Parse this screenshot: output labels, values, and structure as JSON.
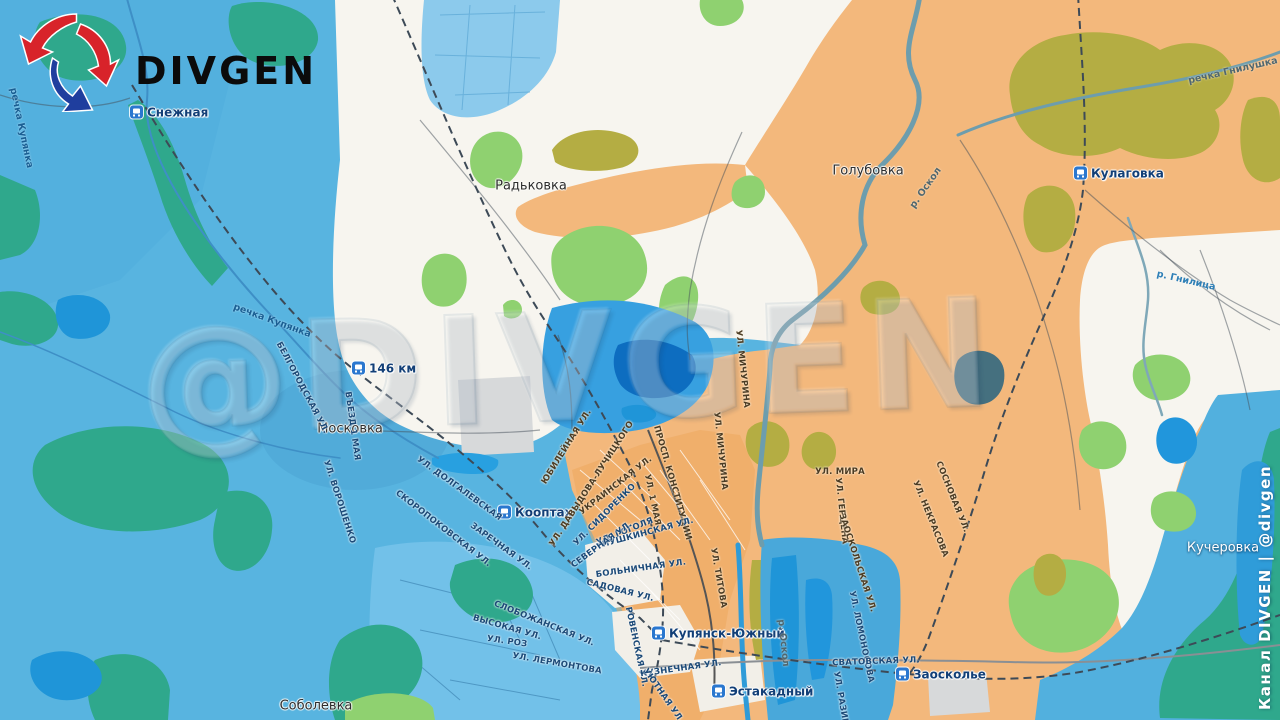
{
  "brand": {
    "logo_text": "DIVGEN"
  },
  "watermark": {
    "text": "@DIVGEN"
  },
  "credit": {
    "text": "Канал DIVGEN | @divgen"
  },
  "palette": {
    "ukraine_zone": "#58b4e0",
    "russia_zone": "#f3b87c",
    "contested_zone": "#f7f5ef",
    "forest_teal": "#2fa88c",
    "forest_light_green": "#8fd170",
    "forest_olive": "#b4ad43",
    "water_bright": "#1f95d8",
    "river_steel": "#6d9dad",
    "station_icon_blue": "#2a77cf",
    "logo_red": "#d8232a",
    "logo_blue": "#1f3e9e"
  },
  "map": {
    "labels": [
      {
        "type": "station",
        "text": "Снежная",
        "x": 130,
        "y": 112,
        "rot": 0,
        "anchor": "left"
      },
      {
        "type": "station",
        "text": "146 км",
        "x": 352,
        "y": 368,
        "rot": 0,
        "anchor": "left"
      },
      {
        "type": "station",
        "text": "Кооптах",
        "x": 498,
        "y": 512,
        "rot": 0,
        "anchor": "left"
      },
      {
        "type": "station",
        "text": "Купянск-Южный",
        "x": 652,
        "y": 633,
        "rot": 0,
        "anchor": "left"
      },
      {
        "type": "station",
        "text": "Эстакадный",
        "x": 712,
        "y": 691,
        "rot": 0,
        "anchor": "left"
      },
      {
        "type": "station",
        "text": "Заосколье",
        "x": 896,
        "y": 674,
        "rot": 0,
        "anchor": "left"
      },
      {
        "type": "station",
        "text": "Кулаговка",
        "x": 1074,
        "y": 173,
        "rot": 0,
        "anchor": "left"
      },
      {
        "type": "settlement",
        "text": "Радьковка",
        "x": 531,
        "y": 186,
        "rot": 0
      },
      {
        "type": "settlement",
        "text": "Голубовка",
        "x": 868,
        "y": 171,
        "rot": 0
      },
      {
        "type": "settlement",
        "text": "Московка",
        "x": 350,
        "y": 429,
        "rot": 0
      },
      {
        "type": "settlement",
        "text": "Соболевка",
        "x": 316,
        "y": 706,
        "rot": 0
      },
      {
        "type": "settlement-light",
        "text": "Кучеровка",
        "x": 1223,
        "y": 548,
        "rot": 0
      },
      {
        "type": "river-blue",
        "text": "речка Купянка",
        "x": 21,
        "y": 128,
        "rot": 78
      },
      {
        "type": "river-blue",
        "text": "речка Купянка",
        "x": 272,
        "y": 321,
        "rot": 20
      },
      {
        "type": "river-steel",
        "text": "р. Оскол",
        "x": 926,
        "y": 188,
        "rot": -55
      },
      {
        "type": "river-steel",
        "text": "р. Оскол",
        "x": 783,
        "y": 643,
        "rot": 84
      },
      {
        "type": "river-steel",
        "text": "речка Гнилушка",
        "x": 1233,
        "y": 71,
        "rot": -13
      },
      {
        "type": "river-bright",
        "text": "р. Гнилица",
        "x": 1186,
        "y": 281,
        "rot": 13
      },
      {
        "type": "street-blue",
        "text": "Белгородская ул.",
        "x": 302,
        "y": 388,
        "rot": 62
      },
      {
        "type": "street-blue",
        "text": "въезд 1 Мая",
        "x": 352,
        "y": 426,
        "rot": 82
      },
      {
        "type": "street-blue",
        "text": "ул. Ворошенко",
        "x": 339,
        "y": 502,
        "rot": 72
      },
      {
        "type": "street-blue",
        "text": "ул. Долгалевская",
        "x": 459,
        "y": 489,
        "rot": 36
      },
      {
        "type": "street-blue",
        "text": "Скоропоковская ул.",
        "x": 443,
        "y": 529,
        "rot": 38
      },
      {
        "type": "street-blue",
        "text": "Заречная ул.",
        "x": 501,
        "y": 547,
        "rot": 36
      },
      {
        "type": "street-blue",
        "text": "Слобожанская ул.",
        "x": 544,
        "y": 624,
        "rot": 22
      },
      {
        "type": "street-blue",
        "text": "Высокая ул.",
        "x": 507,
        "y": 628,
        "rot": 16
      },
      {
        "type": "street-blue",
        "text": "ул. Роз",
        "x": 507,
        "y": 642,
        "rot": 8
      },
      {
        "type": "street-blue",
        "text": "ул. Лермонтова",
        "x": 557,
        "y": 664,
        "rot": 10
      },
      {
        "type": "street-orange",
        "text": "Юбилейная ул.",
        "x": 567,
        "y": 447,
        "rot": -58
      },
      {
        "type": "street-orange",
        "text": "ул. Давыдова-Лучицкого",
        "x": 592,
        "y": 484,
        "rot": -57
      },
      {
        "type": "street-orange",
        "text": "Украинская ул.",
        "x": 616,
        "y": 486,
        "rot": -38
      },
      {
        "type": "street-orange",
        "text": "просп. Конституции",
        "x": 672,
        "y": 483,
        "rot": 74
      },
      {
        "type": "street-orange",
        "text": "ул. 1 Мая",
        "x": 652,
        "y": 500,
        "rot": 78
      },
      {
        "type": "street-blue",
        "text": "ул. Сидоренко",
        "x": 605,
        "y": 515,
        "rot": -45
      },
      {
        "type": "street-blue",
        "text": "ул. Гоголя",
        "x": 625,
        "y": 532,
        "rot": -22
      },
      {
        "type": "street-blue",
        "text": "Пушкинская ул.",
        "x": 648,
        "y": 533,
        "rot": -15
      },
      {
        "type": "street-blue",
        "text": "Северная ул.",
        "x": 602,
        "y": 545,
        "rot": -36
      },
      {
        "type": "street-blue",
        "text": "Больничная ул.",
        "x": 641,
        "y": 569,
        "rot": -8
      },
      {
        "type": "street-blue",
        "text": "Садовая ул.",
        "x": 620,
        "y": 591,
        "rot": 14
      },
      {
        "type": "street-blue",
        "text": "Ровенская ул.",
        "x": 636,
        "y": 647,
        "rot": 78
      },
      {
        "type": "street-blue",
        "text": "Кузнечная ул.",
        "x": 681,
        "y": 669,
        "rot": -8
      },
      {
        "type": "street-blue",
        "text": "Уютная ул.",
        "x": 663,
        "y": 696,
        "rot": 55
      },
      {
        "type": "street-orange",
        "text": "ул. Титова",
        "x": 718,
        "y": 578,
        "rot": 80
      },
      {
        "type": "street-orange",
        "text": "ул. Мичурина",
        "x": 742,
        "y": 369,
        "rot": 84
      },
      {
        "type": "street-orange",
        "text": "ул. Мичурина",
        "x": 720,
        "y": 451,
        "rot": 84
      },
      {
        "type": "street-orange",
        "text": "ул. Мира",
        "x": 840,
        "y": 472,
        "rot": 0
      },
      {
        "type": "street-orange",
        "text": "ул. Герцена",
        "x": 841,
        "y": 511,
        "rot": 84
      },
      {
        "type": "street-orange",
        "text": "Заоскольская ул.",
        "x": 857,
        "y": 563,
        "rot": 72
      },
      {
        "type": "street-orange",
        "text": "ул. Некрасова",
        "x": 930,
        "y": 519,
        "rot": 68
      },
      {
        "type": "street-orange",
        "text": "Сосновая ул.",
        "x": 952,
        "y": 497,
        "rot": 68
      },
      {
        "type": "street-blue",
        "text": "ул. Ломоносова",
        "x": 861,
        "y": 637,
        "rot": 78
      },
      {
        "type": "street-blue",
        "text": "Сватовская ул.",
        "x": 876,
        "y": 662,
        "rot": -2
      },
      {
        "type": "street-blue",
        "text": "ул. Разина",
        "x": 841,
        "y": 702,
        "rot": 80
      }
    ]
  }
}
